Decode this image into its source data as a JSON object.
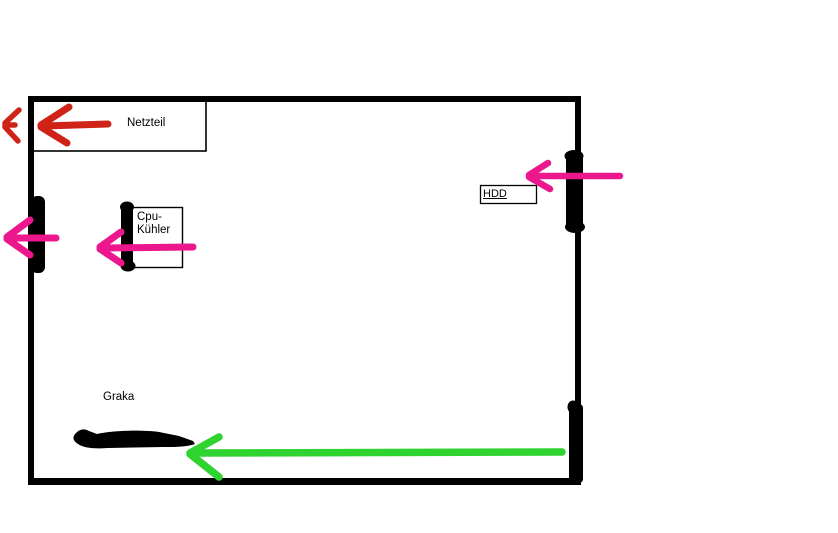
{
  "canvas": {
    "width": 838,
    "height": 533,
    "background": "#ffffff"
  },
  "colors": {
    "outline": "#000000",
    "red": "#d02318",
    "magenta": "#ec168d",
    "green": "#2fd32f",
    "text": "#000000"
  },
  "labels": {
    "psu": "Netzteil",
    "cpu_cooler": "Cpu-\nKühler",
    "hdd": "HDD",
    "gpu": "Graka"
  },
  "arrows": {
    "psu_exhaust": {
      "color_name": "red",
      "direction": "left",
      "meaning": "airflow out through Netzteil"
    },
    "case_exhaust_chevron": {
      "color_name": "red",
      "direction": "left",
      "meaning": "air leaving case"
    },
    "side_fan_out": {
      "color_name": "magenta",
      "direction": "left",
      "meaning": "airflow out through left fan"
    },
    "cpu_airflow": {
      "color_name": "magenta",
      "direction": "left",
      "meaning": "airflow through Cpu-Kühler"
    },
    "hdd_intake": {
      "color_name": "magenta",
      "direction": "left",
      "meaning": "airflow in past HDD fan"
    },
    "gpu_intake": {
      "color_name": "green",
      "direction": "left",
      "meaning": "airflow toward Graka"
    }
  }
}
